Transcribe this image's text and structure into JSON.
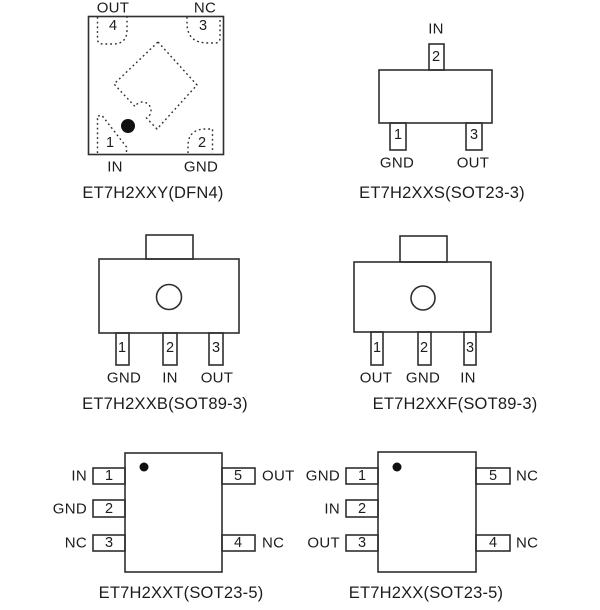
{
  "colors": {
    "background": "#ffffff",
    "line": "#2f2f2f",
    "text": "#1c1c1c",
    "pin1_dot": "#111111"
  },
  "packages": [
    {
      "id": "dfn4",
      "caption": "ET7H2XXY(DFN4)",
      "pins": [
        {
          "number": "4",
          "label": "OUT"
        },
        {
          "number": "3",
          "label": "NC"
        },
        {
          "number": "1",
          "label": "IN"
        },
        {
          "number": "2",
          "label": "GND"
        }
      ]
    },
    {
      "id": "sot23-3",
      "caption": "ET7H2XXS(SOT23-3)",
      "pins": [
        {
          "number": "2",
          "label": "IN"
        },
        {
          "number": "1",
          "label": "GND"
        },
        {
          "number": "3",
          "label": "OUT"
        }
      ]
    },
    {
      "id": "sot89-3-b",
      "caption": "ET7H2XXB(SOT89-3)",
      "pins": [
        {
          "number": "1",
          "label": "GND"
        },
        {
          "number": "2",
          "label": "IN"
        },
        {
          "number": "3",
          "label": "OUT"
        }
      ]
    },
    {
      "id": "sot89-3-f",
      "caption": "ET7H2XXF(SOT89-3)",
      "pins": [
        {
          "number": "1",
          "label": "OUT"
        },
        {
          "number": "2",
          "label": "GND"
        },
        {
          "number": "3",
          "label": "IN"
        }
      ]
    },
    {
      "id": "sot23-5-t",
      "caption": "ET7H2XXT(SOT23-5)",
      "left_pins": [
        {
          "number": "1",
          "label": "IN"
        },
        {
          "number": "2",
          "label": "GND"
        },
        {
          "number": "3",
          "label": "NC"
        }
      ],
      "right_pins": [
        {
          "number": "5",
          "label": "OUT"
        },
        {
          "number": "4",
          "label": "NC"
        }
      ]
    },
    {
      "id": "sot23-5",
      "caption": "ET7H2XX(SOT23-5)",
      "left_pins": [
        {
          "number": "1",
          "label": "GND"
        },
        {
          "number": "2",
          "label": "IN"
        },
        {
          "number": "3",
          "label": "OUT"
        }
      ],
      "right_pins": [
        {
          "number": "5",
          "label": "NC"
        },
        {
          "number": "4",
          "label": "NC"
        }
      ]
    }
  ]
}
